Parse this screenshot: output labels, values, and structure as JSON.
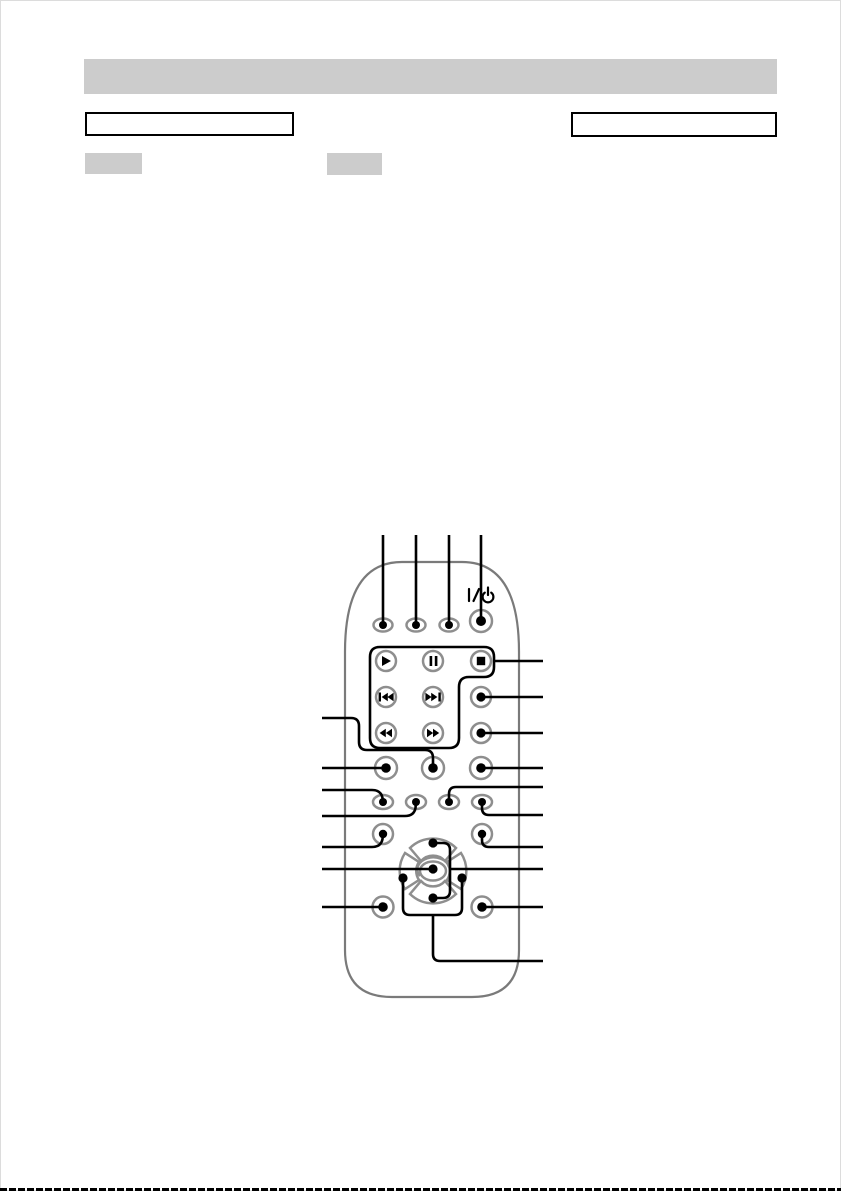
{
  "page": {
    "background": "#ffffff",
    "border_color": "#dcdcdc",
    "scan_line_color": "#000000"
  },
  "header": {
    "bar_text": "",
    "bar_color": "#cccccc"
  },
  "section_boxes": {
    "left_text": "",
    "right_text": ""
  },
  "badges": {
    "badge1_text": "",
    "badge2_text": "",
    "color": "#cccccc"
  },
  "figure": {
    "kind": "remote-control-callout-diagram",
    "power_label": "I/⏻",
    "colors": {
      "callout_line": "#000000",
      "body_outline": "#7a7a7a",
      "button_ring": "#8e8e8e",
      "glyph": "#000000"
    },
    "buttons": [
      "function-1",
      "function-2",
      "function-3",
      "power",
      "play",
      "pause",
      "stop",
      "previous",
      "next",
      "rewind",
      "fast-forward",
      "right-column-1",
      "right-column-2",
      "right-column-3",
      "middle-row-left",
      "middle-row-center",
      "oval-1",
      "oval-2",
      "oval-3",
      "oval-4",
      "small-left",
      "small-right",
      "dpad-up",
      "dpad-down",
      "dpad-left",
      "dpad-right",
      "dpad-center",
      "bottom-left",
      "bottom-right"
    ],
    "callouts": {
      "top": 4,
      "left": 7,
      "right": 10
    }
  }
}
